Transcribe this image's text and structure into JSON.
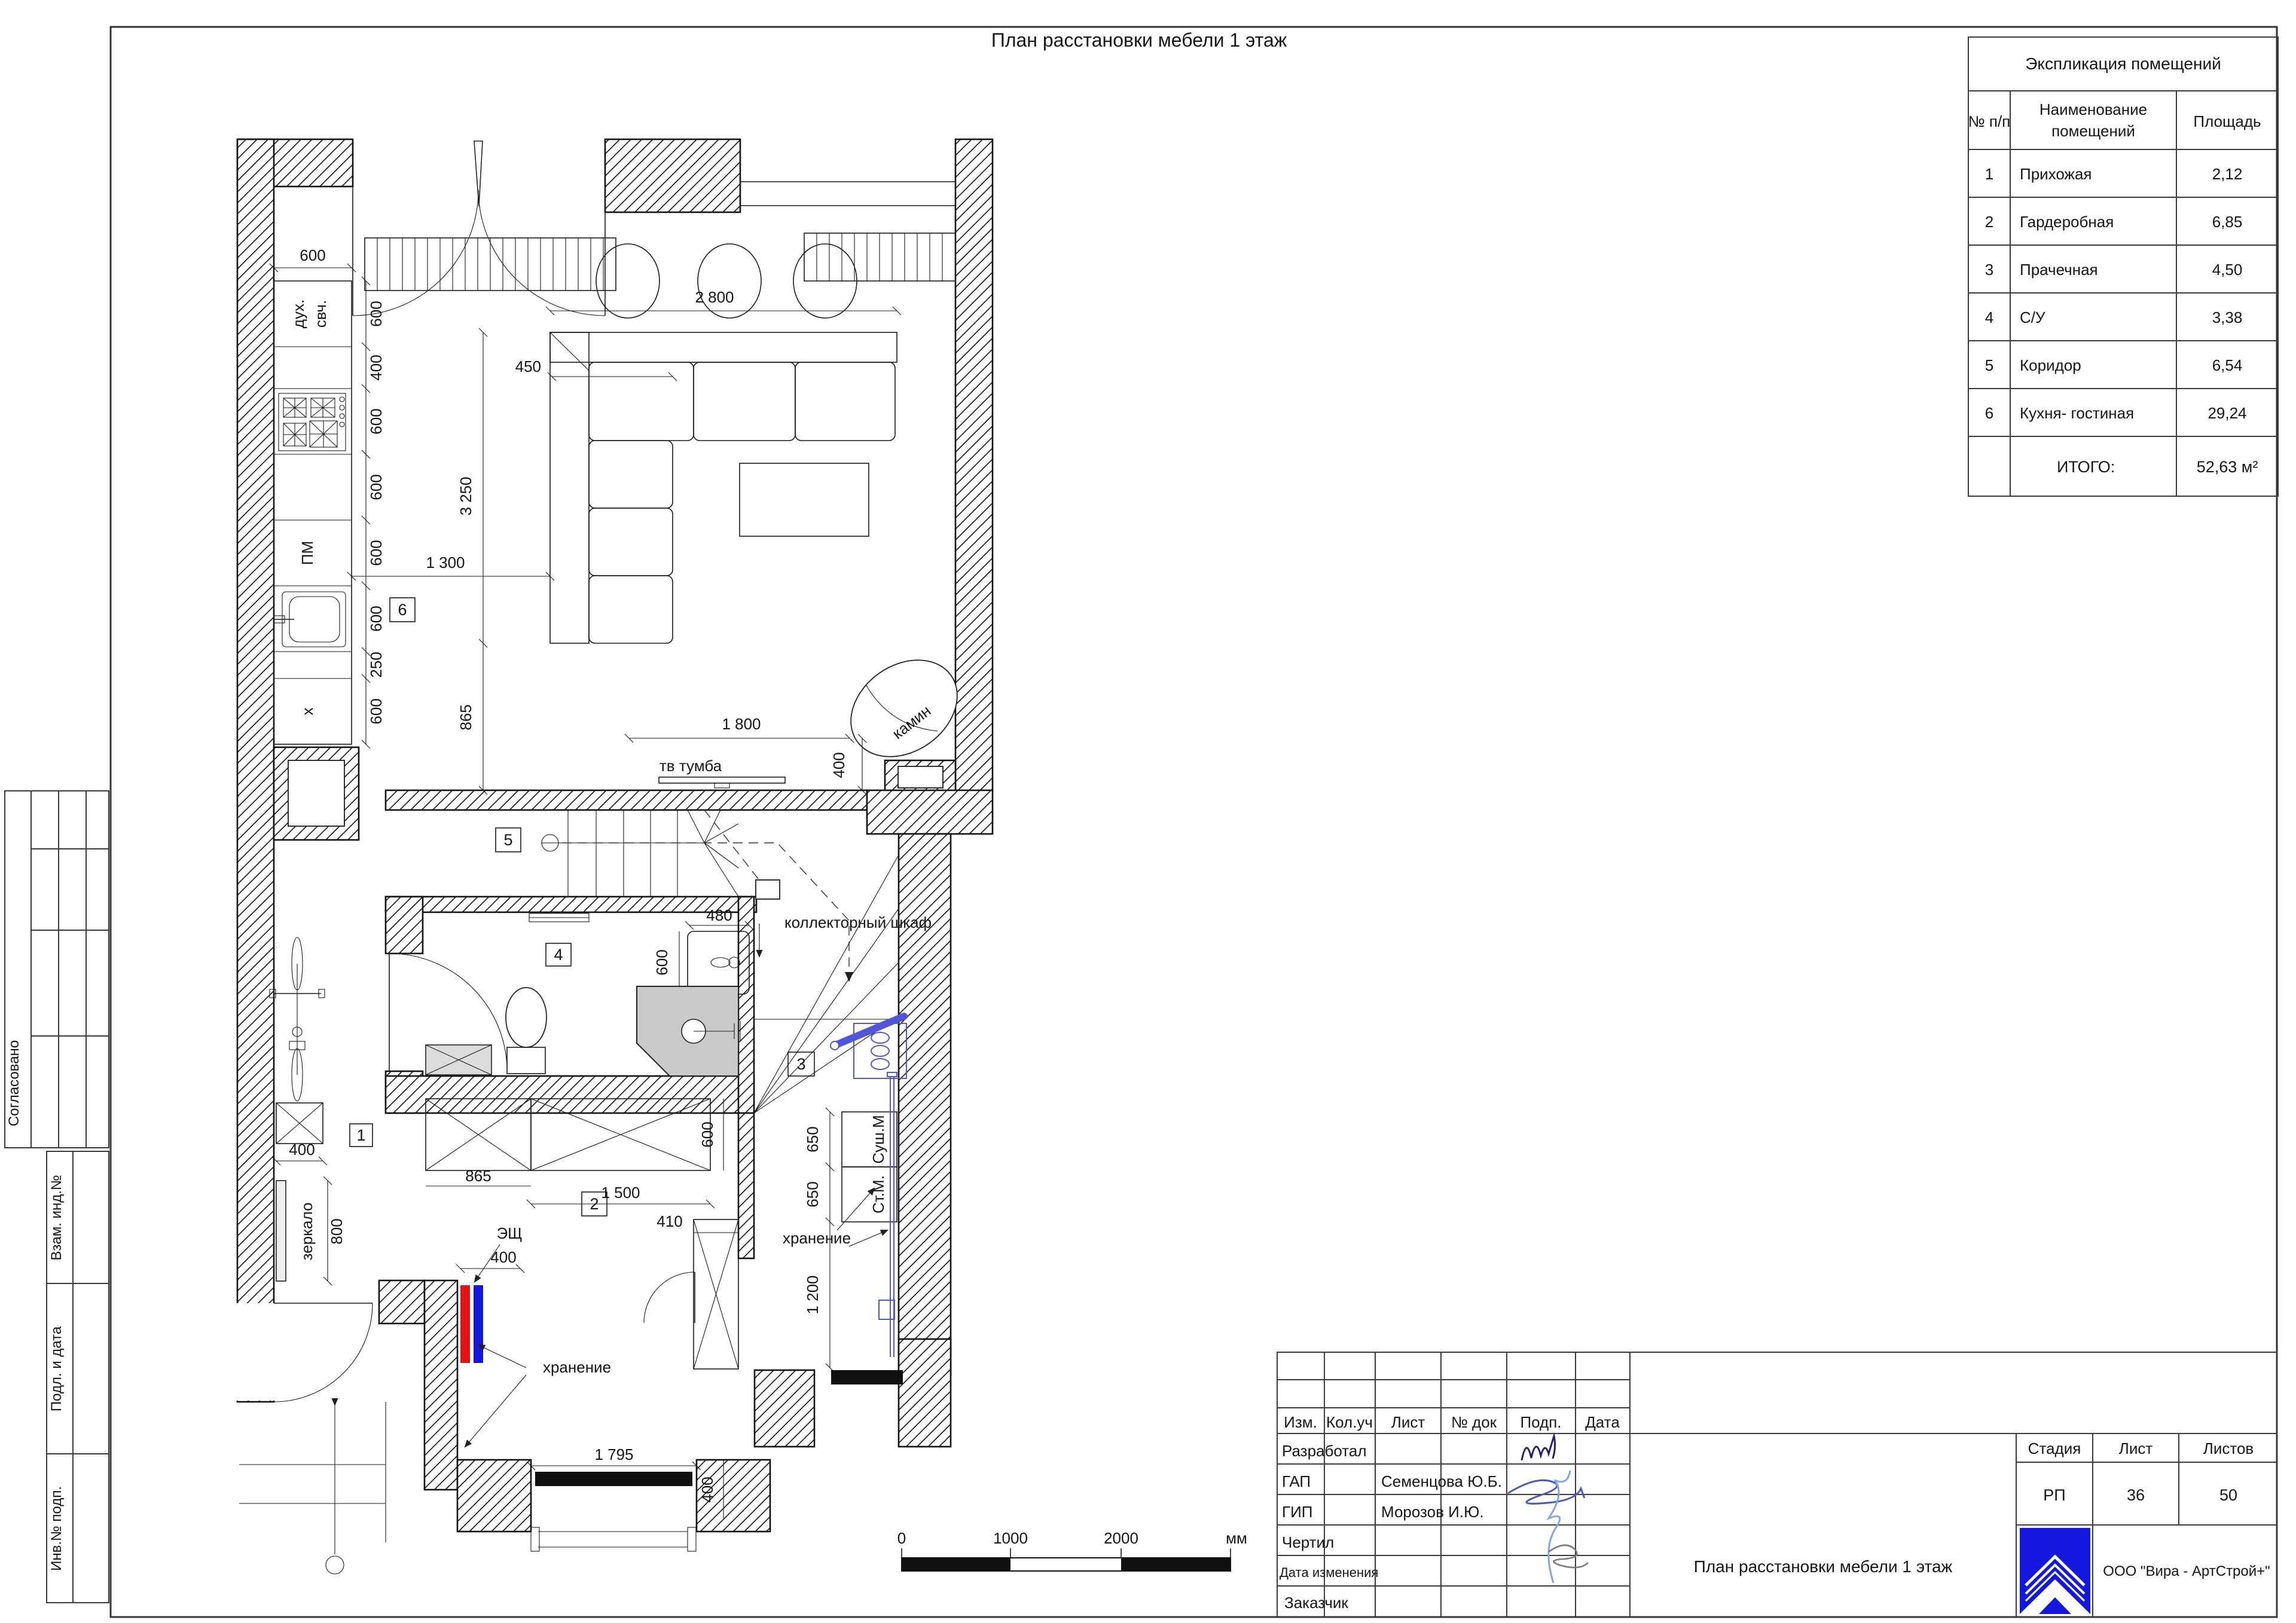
{
  "sheet": {
    "title": "План расстановки мебели 1 этаж"
  },
  "explication": {
    "title": "Экспликация помещений",
    "col_num": "№ п/п",
    "col_name_1": "Наименование",
    "col_name_2": "помещений",
    "col_area": "Площадь",
    "rows": [
      {
        "num": "1",
        "name": "Прихожая",
        "area": "2,12"
      },
      {
        "num": "2",
        "name": "Гардеробная",
        "area": "6,85"
      },
      {
        "num": "3",
        "name": "Прачечная",
        "area": "4,50"
      },
      {
        "num": "4",
        "name": "С/У",
        "area": "3,38"
      },
      {
        "num": "5",
        "name": "Коридор",
        "area": "6,54"
      },
      {
        "num": "6",
        "name": "Кухня- гостиная",
        "area": "29,24"
      }
    ],
    "total_label": "ИТОГО:",
    "total_value": "52,63 м²"
  },
  "stamp": {
    "col_izm": "Изм.",
    "col_kol": "Кол.уч",
    "col_list": "Лист",
    "col_doc": "№ док",
    "col_podp": "Подп.",
    "col_data": "Дата",
    "rows": [
      {
        "label": "Разработал",
        "name": ""
      },
      {
        "label": "ГАП",
        "name": "Семенцова Ю.Б."
      },
      {
        "label": "ГИП",
        "name": "Морозов И.Ю."
      },
      {
        "label": "Чертил",
        "name": ""
      },
      {
        "label": "Дата изменения",
        "name": ""
      },
      {
        "label": "Заказчик",
        "name": ""
      }
    ],
    "stage_label": "Стадия",
    "list_label": "Лист",
    "listov_label": "Листов",
    "stage": "РП",
    "list_num": "36",
    "listov_num": "50",
    "doc_title": "План расстановки мебели 1 этаж",
    "company": "ООО \"Вира - АртСтрой+\""
  },
  "margin": {
    "approved": "Согласовано",
    "vzam": "Взам. инд.№",
    "podl": "Подл. и дата",
    "inv": "Инв.№ подп."
  },
  "scalebar": {
    "t0": "0",
    "t1": "1000",
    "t2": "2000",
    "unit": "мм"
  },
  "plan": {
    "tags": [
      "1",
      "2",
      "3",
      "4",
      "5",
      "6"
    ],
    "labels": {
      "oven_l1": "дух.",
      "oven_l2": "свч.",
      "dishwasher": "ПМ",
      "sink_x": "x",
      "tv_stand": "тв тумба",
      "fireplace": "камин",
      "collector": "коллекторный шкаф",
      "panel": "ЭЩ",
      "storage1": "хранение",
      "storage2": "хранение",
      "mirror": "зеркало",
      "dryer": "Суш.М",
      "washer": "Ст.М."
    },
    "dims": {
      "kitchen_depth": "600",
      "chain": [
        "600",
        "400",
        "600",
        "600",
        "600",
        "600",
        "250",
        "600"
      ],
      "d1300": "1 300",
      "sofa_w": "2 800",
      "sofa_d": "450",
      "sofa_l": "3 250",
      "d865": "865",
      "tv_w": "1 800",
      "tv_d": "400",
      "sink_w": "480",
      "sink_d": "600",
      "st865": "865",
      "st600": "600",
      "st1500": "1 500",
      "cab410": "410",
      "esh400": "400",
      "mir400": "400",
      "mir800": "800",
      "l650a": "650",
      "l650b": "650",
      "l1200": "1 200",
      "bench1795": "1 795",
      "bench400": "400"
    }
  }
}
